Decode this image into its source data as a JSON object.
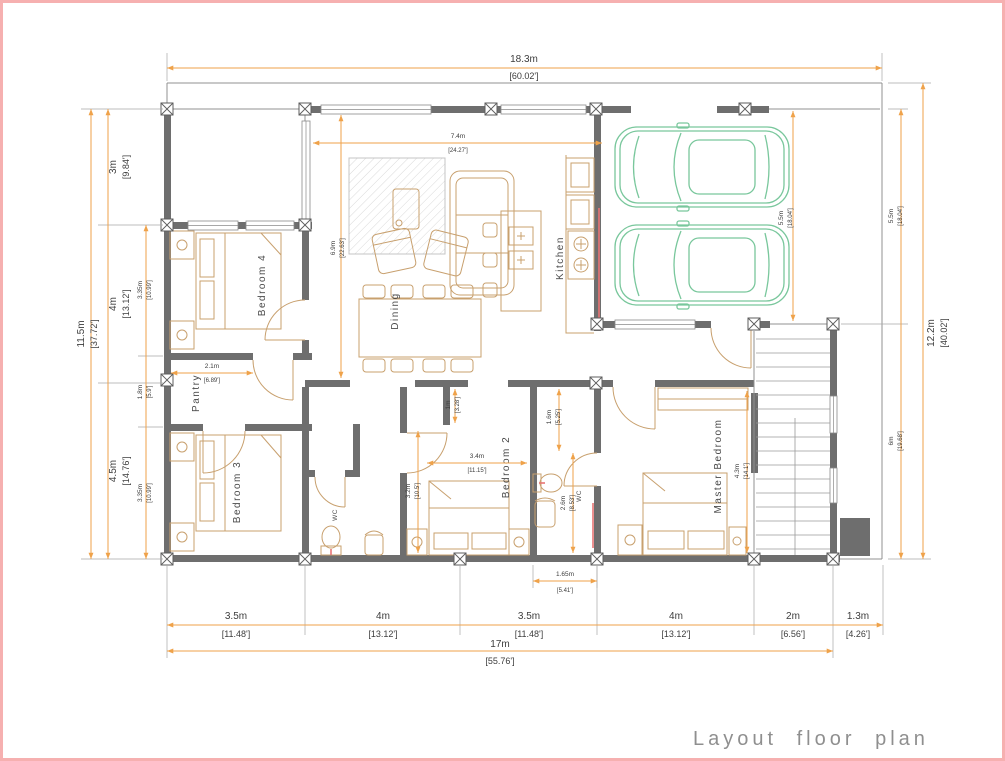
{
  "page": {
    "title": "Layout floor plan"
  },
  "colors": {
    "wall": "#6e6e6e",
    "dimension_line": "#efa24a",
    "furniture": "#c8a06e",
    "car": "#79c79c",
    "accent_red": "#e87474",
    "page_border": "#f6b0b0",
    "label_text": "#4a4a4a",
    "title_text": "#8f8f8f"
  },
  "rooms": {
    "bedroom4": "Bedroom 4",
    "bedroom3": "Bedroom 3",
    "bedroom2": "Bedroom 2",
    "master": "Master Bedroom",
    "pantry": "Pantry",
    "dining": "Dining",
    "kitchen": "Kitchen",
    "wc1": "WC",
    "wc2": "WC"
  },
  "dims": {
    "top_w": {
      "m": "18.3m",
      "ft": "[60.02']"
    },
    "bottom": [
      {
        "m": "3.5m",
        "ft": "[11.48']"
      },
      {
        "m": "4m",
        "ft": "[13.12']"
      },
      {
        "m": "3.5m",
        "ft": "[11.48']"
      },
      {
        "m": "4m",
        "ft": "[13.12']"
      },
      {
        "m": "2m",
        "ft": "[6.56']"
      },
      {
        "m": "1.3m",
        "ft": "[4.26']"
      }
    ],
    "bottom_total": {
      "m": "17m",
      "ft": "[55.76']"
    },
    "left_total": {
      "m": "11.5m",
      "ft": "[37.72']"
    },
    "left_seg": [
      {
        "m": "3m",
        "ft": "[9.84']"
      },
      {
        "m": "4m",
        "ft": "[13.12']"
      },
      {
        "m": "4.5m",
        "ft": "[14.76']"
      }
    ],
    "left_inner": [
      {
        "m": "3.35m",
        "ft": "[10.99']"
      },
      {
        "m": "1.8m",
        "ft": "[5.9']"
      },
      {
        "m": "3.35m",
        "ft": "[10.99']"
      }
    ],
    "right_total": {
      "m": "12.2m",
      "ft": "[40.02']"
    },
    "right_seg": [
      {
        "m": "5.5m",
        "ft": "[18.04']"
      },
      {
        "m": "6m",
        "ft": "[19.68']"
      }
    ],
    "living_w": {
      "m": "7.4m",
      "ft": "[24.27']"
    },
    "living_h": {
      "m": "6.9m",
      "ft": "[22.63']"
    },
    "garage_d": {
      "m": "5.5m",
      "ft": "[18.04']"
    },
    "pantry_w": {
      "m": "2.1m",
      "ft": "[6.89']"
    },
    "niche": {
      "m": "1m",
      "ft": "[3.28']"
    },
    "wc2_top": {
      "m": "1.6m",
      "ft": "[5.25']"
    },
    "wc2_bot": {
      "m": "2.6m",
      "ft": "[8.53']"
    },
    "bed2_h": {
      "m": "3.2m",
      "ft": "[10.5']"
    },
    "bed2_w": {
      "m": "3.4m",
      "ft": "[11.15']"
    },
    "master_h": {
      "m": "4.3m",
      "ft": "[14.1']"
    },
    "wc_w": {
      "m": "1.65m",
      "ft": "[5.41']"
    }
  }
}
